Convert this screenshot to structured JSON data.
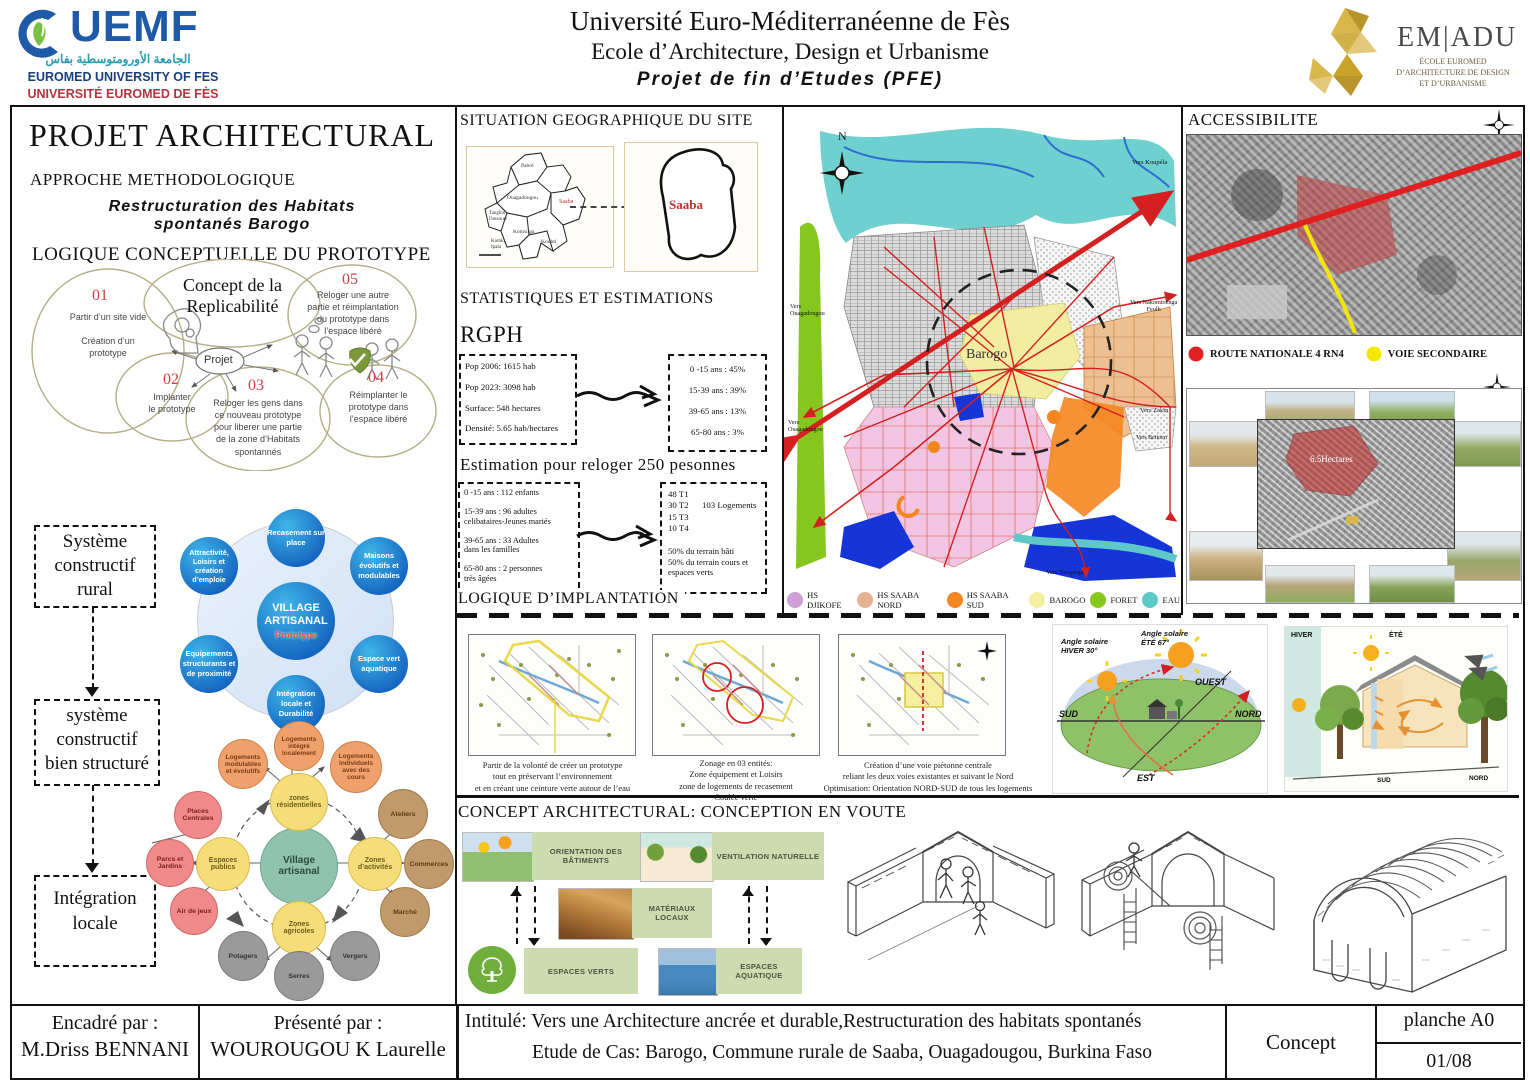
{
  "header": {
    "uemf_name": "UEMF",
    "uemf_arabic": "الجامعة الأورومتوسطية بفاس",
    "uemf_en": "EUROMED UNIVERSITY OF FES",
    "uemf_fr": "UNIVERSITÉ EUROMED DE FÈS",
    "title_line1": "Université Euro-Méditerranéenne de Fès",
    "title_line2": "Ecole d’Architecture, Design et Urbanisme",
    "title_line3": "Projet de fin d’Etudes (PFE)",
    "emadu_name": "EM|ADU",
    "emadu_sub": "ÉCOLE EUROMED\nD’ARCHITECTURE DE DESIGN\nET D’URBANISME"
  },
  "left_panel": {
    "title": "PROJET ARCHITECTURAL",
    "approche_title": "APPROCHE METHODOLOGIQUE",
    "approche_subtitle": "Restructuration des Habitats\nspontanés Barogo",
    "concept_title": "Concept de la\nReplicabilité",
    "concept_center": "Projet",
    "steps": [
      {
        "num": "01",
        "text": "Partir d’un site vide\n\nCréation d’un\nprototype"
      },
      {
        "num": "02",
        "text": "Implanter\nle prototype"
      },
      {
        "num": "03",
        "text": "Reloger les gens dans\nce nouveau prototype\npour liberer une partie\nde la zone d’Habitats\nspontannés"
      },
      {
        "num": "04",
        "text": "Réimplanter le\nprototype dans\nl’espace libéré"
      },
      {
        "num": "05",
        "text": "Reloger une autre\npartie et réimplantation\ndu prototype dans\nl’espace libéré"
      }
    ],
    "logique_title": "LOGIQUE CONCEPTUELLE DU PROTOTYPE",
    "flow_boxes": [
      "Système\nconstructif\nrural",
      "système\nconstructif\nbien structuré",
      "Intégration\nlocale"
    ],
    "hub_center_title": "VILLAGE\nARTISANAL",
    "hub_center_sub": "Prototype",
    "hub_items": [
      "Recasement sur\nplace",
      "Maisons\névolutifs et\nmodulables",
      "Espace vert\naquatique",
      "Intégration\nlocale et\nDurabilité",
      "Equipements\nstructurants et\nde proximité",
      "Attractivité,\nLoisirs et\ncréation\nd’emploie"
    ],
    "village_center": "Village\nartisanal",
    "village_zones": [
      "zones\nrésidentielles",
      "Zones\nd’activités",
      "Zones\nagricoles",
      "Espaces\npublics"
    ],
    "village_logements": [
      "Logements\nmodulables\net évolutifs",
      "Logements\nintégré\nlocalement",
      "Logements\nindividuels\navec des\ncours"
    ],
    "village_espaces": [
      "Places\nCentrales",
      "Parcs et\nJardins",
      "Air de jeux"
    ],
    "village_activites": [
      "Ateliers",
      "Commerces",
      "Marché"
    ],
    "village_agricoles": [
      "Potagers",
      "Serres",
      "Vergers"
    ]
  },
  "situation": {
    "title": "SITUATION GEOGRAPHIQUE DU SITE",
    "site_label": "Saaba",
    "region_labels": [
      "Pabré",
      "Ouagadougou",
      "Saaba",
      "Tanghin\nDassouri",
      "Komsilga",
      "Komki\nIpala",
      "Koubri"
    ]
  },
  "stats": {
    "title": "STATISTIQUES ET ESTIMATIONS",
    "rgph_title": "RGPH",
    "rgph_box": "Pop 2006: 1615 hab\n\nPop 2023: 3098 hab\n\nSurface: 548 hectares\n\nDensité: 5.65 hab/hectares",
    "age_box": "0 -15 ans : 45%\n\n15-39 ans : 39%\n\n39-65 ans : 13%\n\n65-80 ans : 3%",
    "estimation_title": "Estimation pour reloger 250 pesonnes",
    "estimation_box": "0 -15 ans : 112 enfants\n\n15-39 ans : 96 adultes\ncelibataires-Jeunes mariés\n\n39-65 ans : 33 Adultes\ndans les familles\n\n65-80 ans : 2 personnes\ntrès âgées",
    "logements_box_left": "48 T1\n30 T2\n15 T3\n10 T4",
    "logements_total": "103 Logements",
    "logements_bottom": "50% du terrain bâti\n50% du terrain cours et\nespaces verts"
  },
  "map": {
    "label": "Barogo",
    "north": "N",
    "directions": [
      "Vers Koupéla",
      "Vers Nakomtoenga\nFeulh",
      "Vers Zakin",
      "Vers Betioen",
      "Vers Tangsega",
      "Vers\nOuagadougou",
      "Vers\nOuagadougou"
    ],
    "legend": [
      {
        "label": "HS DJIKOFE",
        "color": "#cf9fd8"
      },
      {
        "label": "HS SAABA NORD",
        "color": "#e6b28e"
      },
      {
        "label": "HS SAABA SUD",
        "color": "#f5861f"
      },
      {
        "label": "BAROGO",
        "color": "#f2f0a0"
      },
      {
        "label": "FORET",
        "color": "#85c71e"
      },
      {
        "label": "EAU",
        "color": "#5ec8c8"
      }
    ]
  },
  "access": {
    "title": "ACCESSIBILITE",
    "legend": [
      {
        "label": "ROUTE NATIONALE 4 RN4",
        "color": "#e02020"
      },
      {
        "label": "VOIE SECONDAIRE",
        "color": "#f5e600"
      }
    ],
    "area_label": "6.5Hectares"
  },
  "implantation": {
    "title": "LOGIQUE D’IMPLANTATION",
    "captions": [
      "Partir de la volonté de créer un prototype\ntout en préservant l’environnement\net en créant une ceinture verte autour de l’eau",
      "Zonage en 03 entités:\nZone équipement et Loisirs\nzone de logements de recasement\nCoulée verte",
      "Création d’une voie piétonne  centrale\nreliant les deux voies existantes et suivant le Nord\nOptimisation: Orientation NORD-SUD de tous les logements"
    ],
    "sun_winter": "Angle solaire\nHIVER 30°",
    "sun_summer": "Angle solaire\nÉTÉ 67°",
    "sun_ouest": "OUEST",
    "sun_nord": "NORD",
    "sun_sud": "SUD",
    "sun_est": "EST",
    "section_hiver": "HIVER",
    "section_ete": "ÉTÉ",
    "section_sud": "SUD",
    "section_nord": "NORD"
  },
  "concept_arch": {
    "title": "CONCEPT ARCHITECTURAL: CONCEPTION EN VOUTE",
    "items": [
      "ORIENTATION DES BÂTIMENTS",
      "VENTILATION NATURELLE",
      "MATÉRIAUX LOCAUX",
      "ESPACES VERTS",
      "ESPACES AQUATIQUE"
    ]
  },
  "footer": {
    "encadre_label": "Encadré par :",
    "encadre_name": "M.Driss BENNANI",
    "presente_label": "Présenté par :",
    "presente_name": "WOUROUGOU K Laurelle",
    "intitule": "Intitulé: Vers une Architecture ancrée et durable,Restructuration des habitats spontanés",
    "etude": "Etude de Cas: Barogo, Commune rurale de Saaba, Ouagadougou, Burkina Faso",
    "phase": "Concept",
    "planche": "planche A0",
    "page": "01/08"
  }
}
